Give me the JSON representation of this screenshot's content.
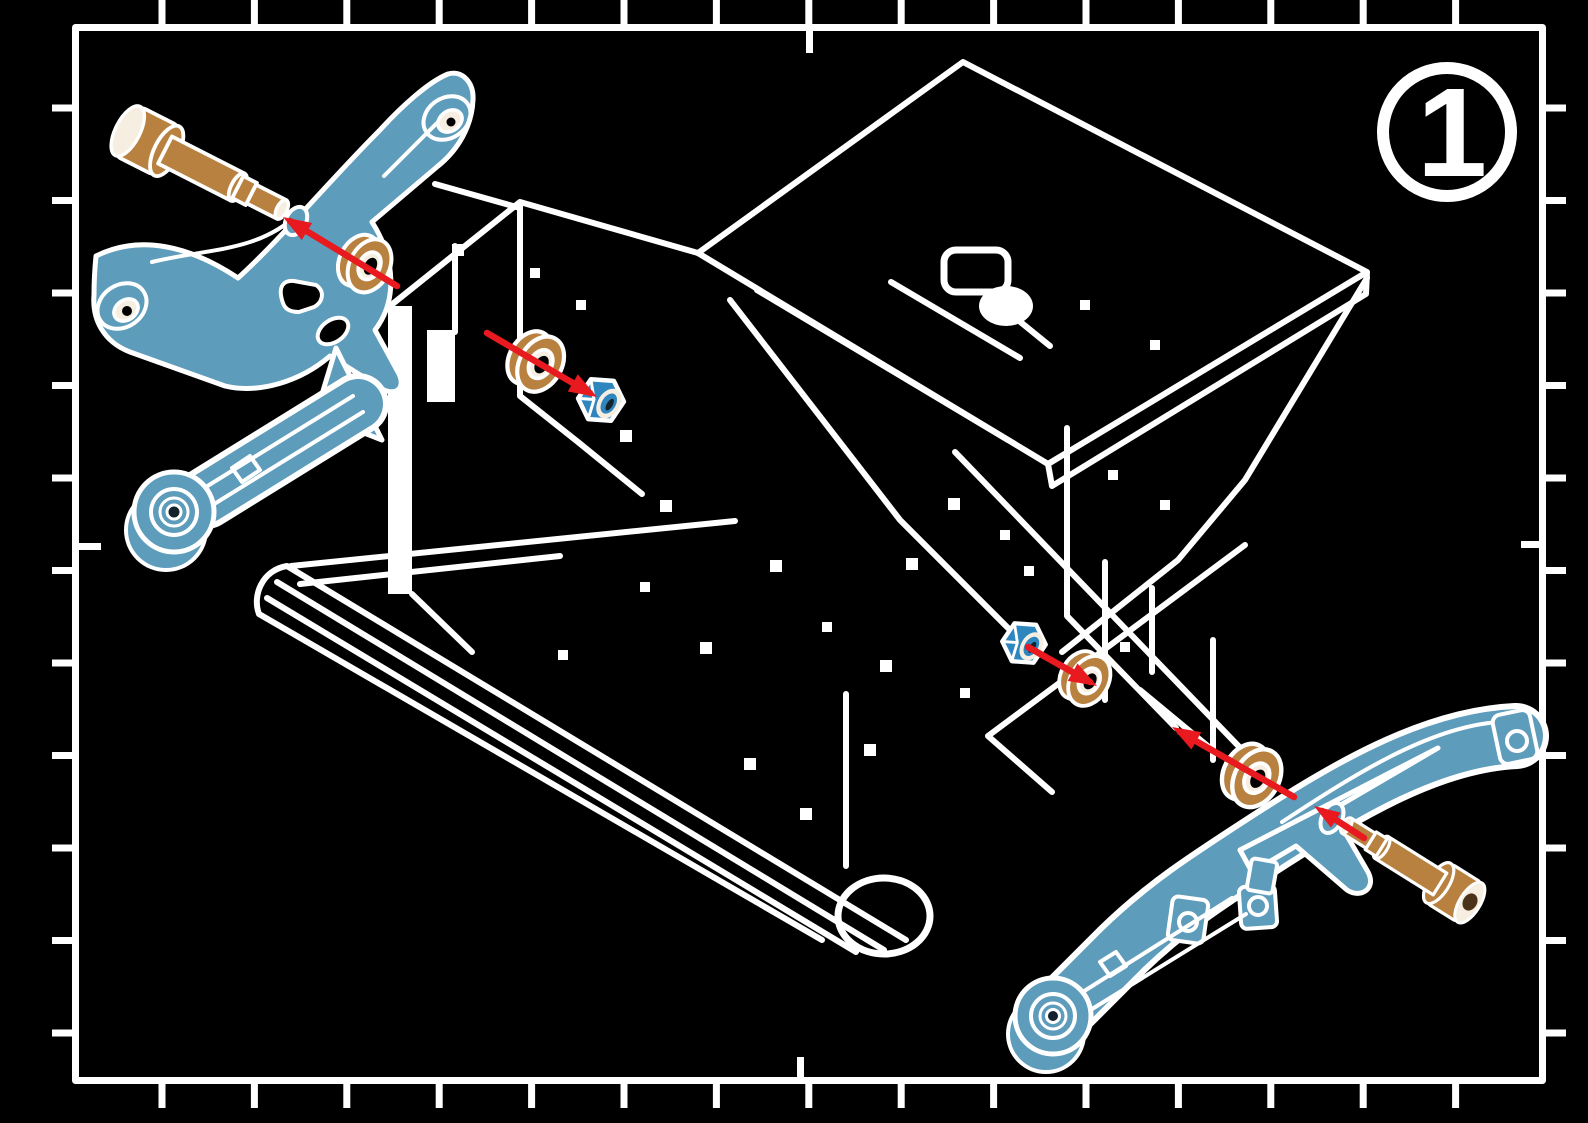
{
  "badge": {
    "step_number": "1"
  },
  "colors": {
    "background": "#000000",
    "linework": "#ffffff",
    "part_blue": "#5e9cbb",
    "nut_blue": "#2f86bf",
    "hardware_tan": "#b8813f",
    "hardware_cream": "#f6efe1",
    "arrow_red": "#e8191f",
    "recess_dark": "#14222b",
    "socket_brown": "#4a3318"
  },
  "parts": {
    "chassis": "chassis-wireframe",
    "left_assembly": [
      "steering-bellcrank",
      "cap-screw",
      "washer",
      "washer",
      "locknut"
    ],
    "right_assembly": [
      "steering-arm",
      "cap-screw",
      "washer",
      "washer",
      "locknut"
    ],
    "assembly_arrow_count": 5
  }
}
